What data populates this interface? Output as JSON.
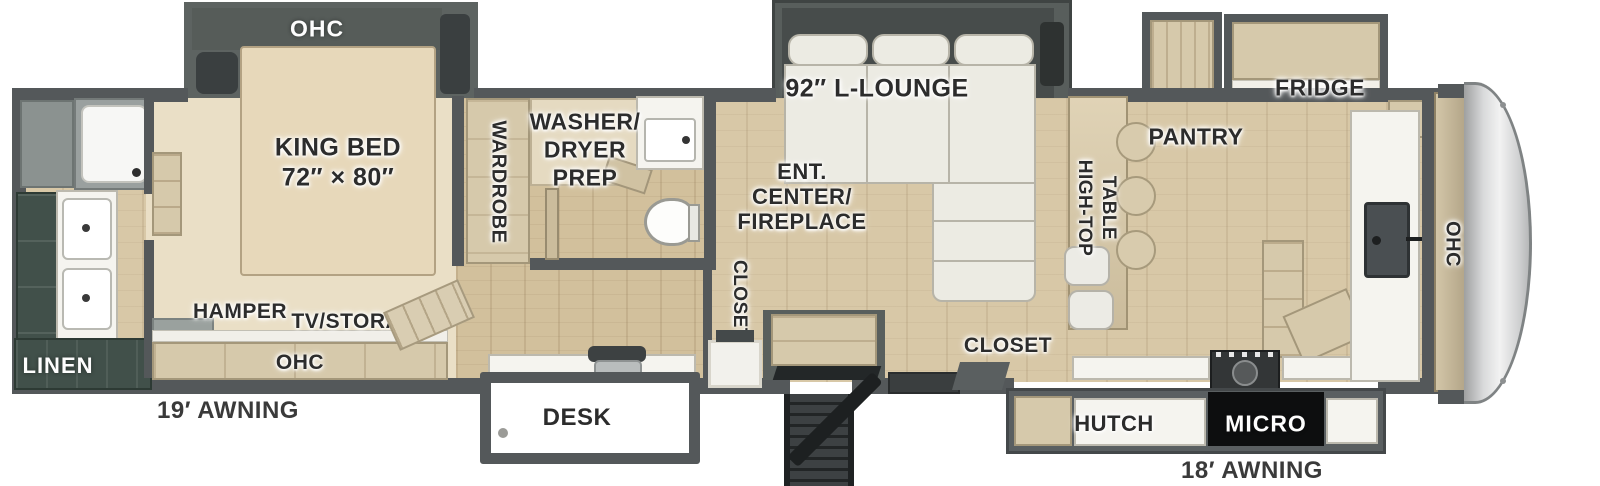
{
  "colors": {
    "wall": "#54585a",
    "floor_wood": "#d8c8a7",
    "bedroom_carpet": "#eadfc6",
    "cabinet_wood": "#d6c9ab",
    "bath_cabinet_green": "#41504a",
    "fixture_white": "#f5f4ef",
    "micro_black": "#0d0e0f",
    "front_cap_gray": "#d9dadb"
  },
  "labels": {
    "bedroom_slide_ohc": "OHC",
    "king_bed_line1": "KING BED",
    "king_bed_line2": "72″ × 80″",
    "wardrobe": "WARDROBE",
    "washer_line1": "WASHER/",
    "washer_line2": "DRYER",
    "washer_line3": "PREP",
    "lounge": "92″ L-LOUNGE",
    "ent_line1": "ENT.",
    "ent_line2": "CENTER/",
    "ent_line3": "FIREPLACE",
    "closet_mid": "CLOSET",
    "hamper": "HAMPER",
    "tv_storage": "TV/STORAGE",
    "bedroom_ohc": "OHC",
    "linen": "LINEN",
    "awning_rear": "19′ AWNING",
    "desk": "DESK",
    "pantry": "PANTRY",
    "fridge": "FRIDGE",
    "hightop_line1": "HIGH-TOP",
    "hightop_line2": "TABLE",
    "front_ohc": "OHC",
    "closet_kitchen": "CLOSET",
    "hutch": "HUTCH",
    "micro": "MICRO",
    "awning_front": "18′ AWNING"
  }
}
